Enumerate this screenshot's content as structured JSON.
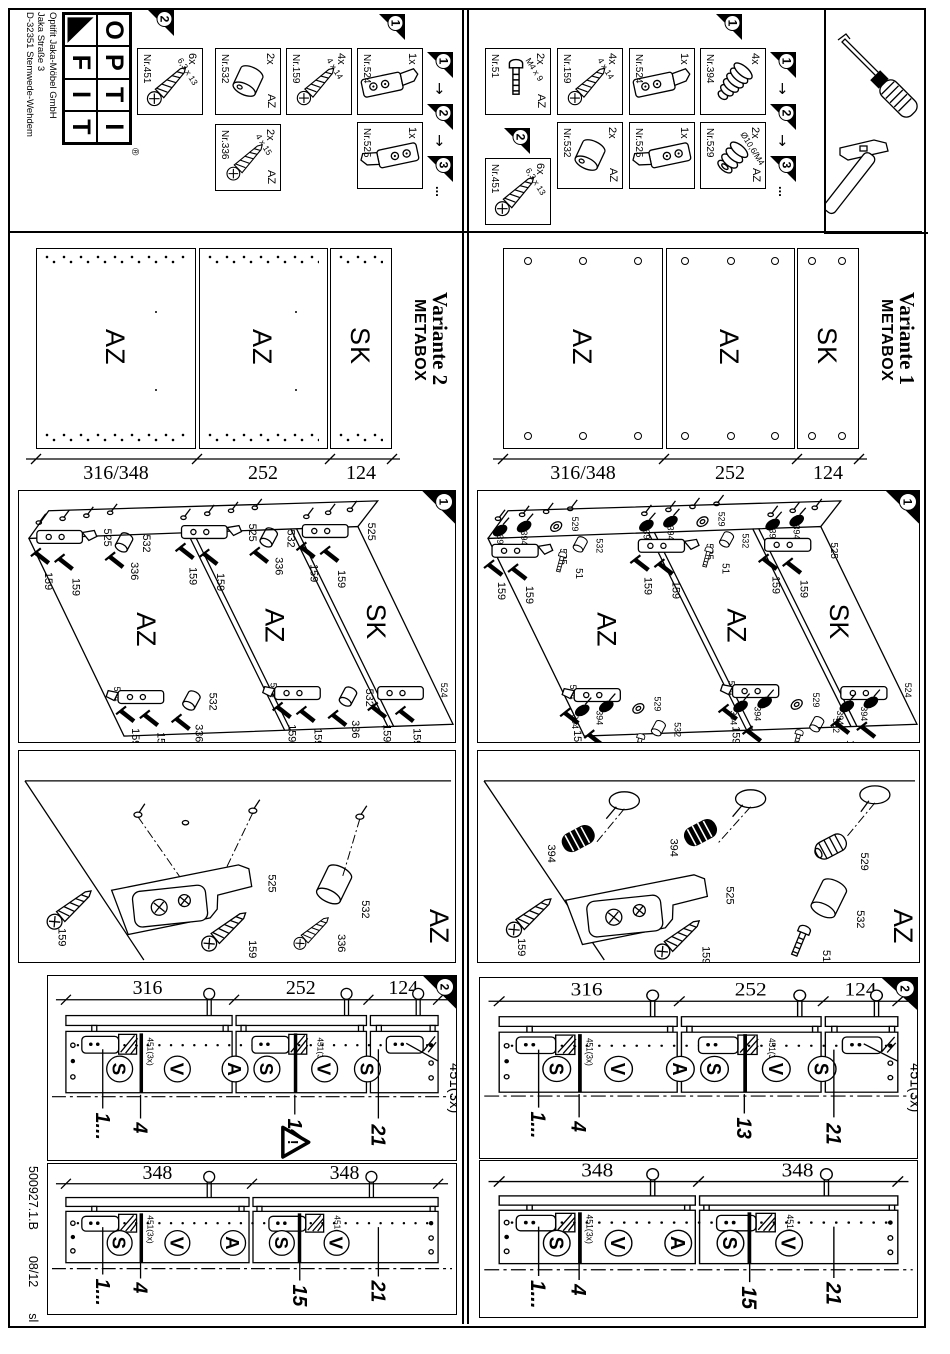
{
  "page": {
    "logo": {
      "top": [
        "O",
        "P",
        "T",
        "I"
      ],
      "bottom": [
        "F",
        "I",
        "T"
      ],
      "reg": "®"
    },
    "company": [
      "Optifit Jaka-Möbel GmbH",
      "Jaka Straße 3",
      "D-32351 Stemwede-Wehdem"
    ],
    "footer": {
      "doc_no": "500927.1.B",
      "date": "08/12",
      "initials": "sl"
    }
  },
  "flags": {
    "f1": "1",
    "f2": "2",
    "f3": "3",
    "more": "...",
    "arrow": "↓"
  },
  "parts_v2": [
    {
      "qty": "6x",
      "nr": "Nr.451",
      "spec": "6,3 x 13",
      "tag": ""
    },
    {
      "qty": "2x",
      "nr": "Nr.532",
      "spec": "",
      "tag": "AZ"
    },
    {
      "qty": "2x",
      "nr": "Nr.336",
      "spec": "4 x 15",
      "tag": "AZ"
    },
    {
      "qty": "4x",
      "nr": "Nr.159",
      "spec": "4 x 14",
      "tag": ""
    },
    {
      "qty": "1x",
      "nr": "Nr.524",
      "spec": "",
      "tag": ""
    },
    {
      "qty": "1x",
      "nr": "Nr.525",
      "spec": "",
      "tag": ""
    }
  ],
  "parts_v1": [
    {
      "qty": "2x",
      "nr": "Nr.51",
      "spec": "M4 x 9",
      "tag": "AZ"
    },
    {
      "qty": "4x",
      "nr": "Nr.159",
      "spec": "4 x 14",
      "tag": ""
    },
    {
      "qty": "1x",
      "nr": "Nr.524",
      "spec": "",
      "tag": ""
    },
    {
      "qty": "4x",
      "nr": "Nr.394",
      "spec": "",
      "tag": ""
    },
    {
      "qty": "6x",
      "nr": "Nr.451",
      "spec": "6,3 x 13",
      "tag": ""
    },
    {
      "qty": "2x",
      "nr": "Nr.532",
      "spec": "",
      "tag": "AZ"
    },
    {
      "qty": "1x",
      "nr": "Nr.525",
      "spec": "",
      "tag": ""
    },
    {
      "qty": "2x",
      "nr": "Nr.529",
      "spec": "Ø10,6/M4",
      "tag": "AZ"
    }
  ],
  "variant2": {
    "title": "Variante 2",
    "subtitle": "METABOX"
  },
  "variant1": {
    "title": "Variante 1",
    "subtitle": "METABOX"
  },
  "panels": {
    "labels": [
      "AZ",
      "AZ",
      "SK"
    ],
    "dims": [
      "316/348",
      "252",
      "124"
    ]
  },
  "step1": {
    "v2": {
      "b525": "525",
      "b524": "524",
      "c532": "532",
      "s336": "336",
      "s159": "159"
    },
    "v1": {
      "b525": "525",
      "b524": "524",
      "c532": "532",
      "d394": "394",
      "h529": "529",
      "s51": "51",
      "s159": "159"
    }
  },
  "detail": {
    "v2": {
      "s159": "159",
      "b525": "525",
      "c532": "532",
      "s336": "336",
      "panel": "AZ"
    },
    "v1": {
      "s159": "159",
      "d394": "394",
      "h529": "529",
      "c532": "532",
      "s51": "51",
      "b525": "525",
      "panel": "AZ"
    }
  },
  "drill": {
    "a_dims": [
      "316",
      "252",
      "124"
    ],
    "b_dims": [
      "348",
      "348"
    ],
    "slots_a": [
      "S",
      "V",
      "A",
      "S",
      "V",
      "S"
    ],
    "slots_b": [
      "S",
      "V",
      "A",
      "S",
      "V"
    ],
    "m1": "1...",
    "m4": "4",
    "m13": "13",
    "m14": "14",
    "m15": "15",
    "m21": "21",
    "fastener": "451(3x)",
    "warn": "!"
  }
}
